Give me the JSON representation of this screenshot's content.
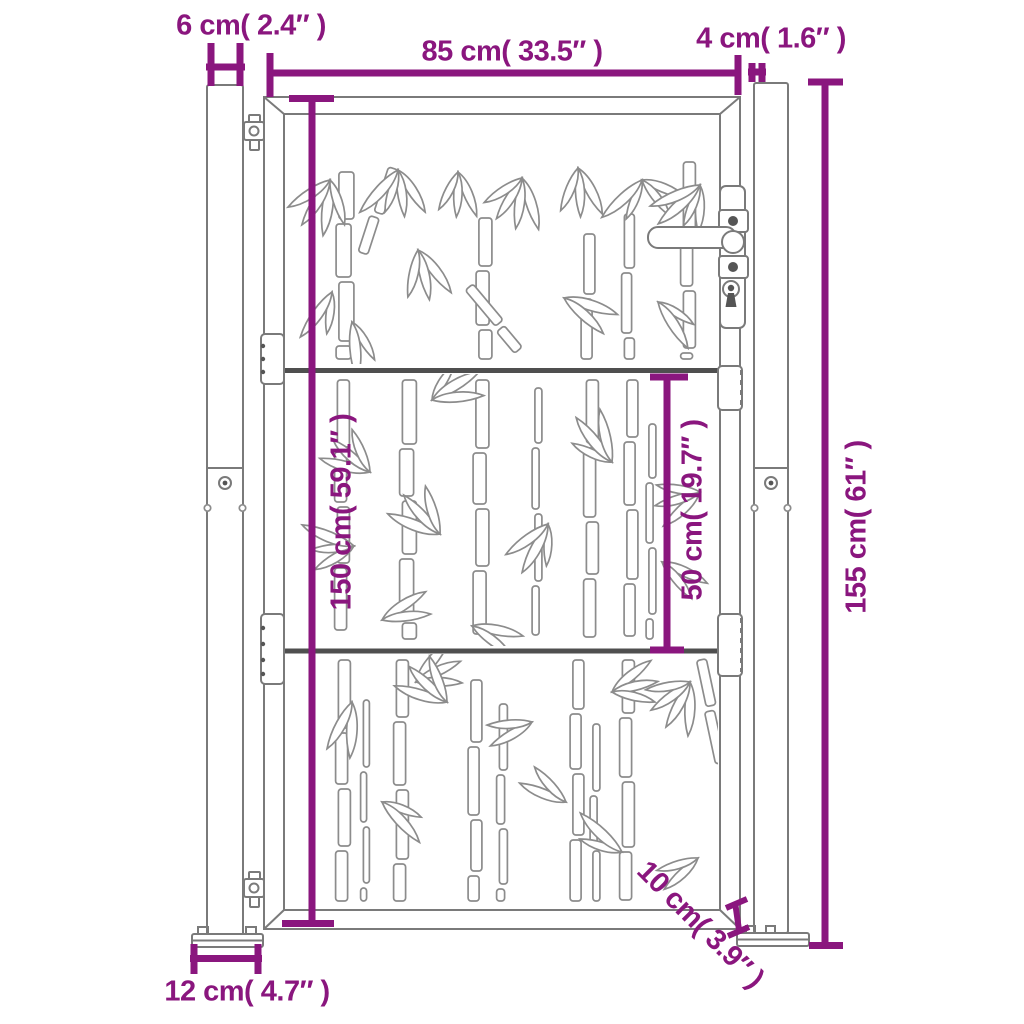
{
  "colors": {
    "dimension_accent": "#8a167e",
    "outline_gray": "#7a7a7a",
    "rail_gray": "#4f4f4f",
    "background": "#ffffff"
  },
  "labels": {
    "post_width": "6 cm( 2.4″ )",
    "gate_width": "85 cm( 33.5″ )",
    "gap_width": "4 cm( 1.6″ )",
    "gate_height": "150 cm( 59.1″ )",
    "mid_section_height": "50 cm( 19.7″ )",
    "total_height": "155 cm( 61″ )",
    "ground_clearance": "10 cm( 3.9″ )",
    "base_plate_width": "12 cm( 4.7″ )"
  }
}
